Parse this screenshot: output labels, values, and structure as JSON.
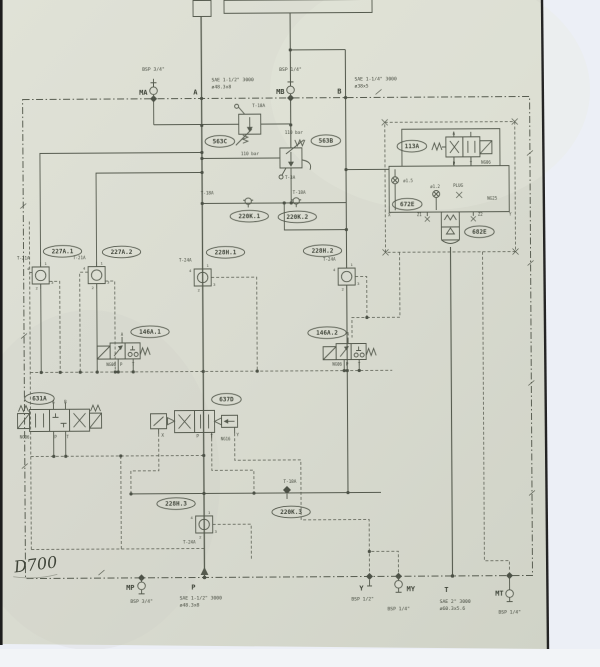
{
  "note": {
    "handwriting": "D700"
  },
  "oval_labels": [
    {
      "id": "563C",
      "x": 221,
      "y": 141
    },
    {
      "id": "563B",
      "x": 327,
      "y": 141
    },
    {
      "id": "220K.1",
      "x": 250,
      "y": 216
    },
    {
      "id": "220K.2",
      "x": 298,
      "y": 217
    },
    {
      "id": "113A",
      "x": 413,
      "y": 147
    },
    {
      "id": "672E",
      "x": 408,
      "y": 205
    },
    {
      "id": "682E",
      "x": 480,
      "y": 233
    },
    {
      "id": "227A.1",
      "x": 63,
      "y": 250
    },
    {
      "id": "227A.2",
      "x": 122,
      "y": 251
    },
    {
      "id": "228H.1",
      "x": 226,
      "y": 252
    },
    {
      "id": "228H.2",
      "x": 323,
      "y": 251
    },
    {
      "id": "146A.1",
      "x": 150,
      "y": 331
    },
    {
      "id": "146A.2",
      "x": 327,
      "y": 333
    },
    {
      "id": "631A",
      "x": 39,
      "y": 397
    },
    {
      "id": "637D",
      "x": 226,
      "y": 399
    },
    {
      "id": "228H.3",
      "x": 175,
      "y": 503
    },
    {
      "id": "220K.3",
      "x": 290,
      "y": 512
    }
  ],
  "check_valves": [
    {
      "label": "T-21A",
      "cx": 41,
      "cy": 274
    },
    {
      "label": "T-21A",
      "cx": 97,
      "cy": 274
    },
    {
      "label": "T-24A",
      "cx": 203,
      "cy": 277
    },
    {
      "label": "T-24A",
      "cx": 347,
      "cy": 277
    },
    {
      "label": "T-24A",
      "cx": 203,
      "cy": 524,
      "below": true
    }
  ],
  "test_points": [
    {
      "x": 249,
      "y": 201
    },
    {
      "x": 297,
      "y": 201
    },
    {
      "x": 286,
      "y": 490,
      "diamond": true
    }
  ],
  "ports_top": {
    "line_y": 98,
    "items": [
      {
        "id": "MA",
        "kind": "gauge",
        "x": 155,
        "thread": "BSP 3/4\"",
        "thread_y": 70,
        "dx": -6,
        "dy": -4
      },
      {
        "id": "A",
        "kind": "line",
        "x": 203,
        "spec": [
          "SAE 1-1/2\" 3000",
          "ø48.3x8"
        ],
        "spec_x": 213,
        "spec_y": 81,
        "dx": -4,
        "dy": -4
      },
      {
        "id": "MB",
        "kind": "gauge",
        "x": 292,
        "thread": "BSP 1/4\"",
        "thread_y": 71,
        "dx": -6,
        "dy": -4
      },
      {
        "id": "B",
        "kind": "line",
        "x": 347,
        "spec": [
          "SAE 1-1/4\" 3000",
          "ø38x5"
        ],
        "spec_x": 356,
        "spec_y": 81,
        "dx": -4,
        "dy": -4
      }
    ]
  },
  "ports_bottom": {
    "line_y": 577,
    "items": [
      {
        "id": "MP",
        "kind": "gauge",
        "x": 140,
        "thread": "BSP 3/4\"",
        "thread_y": 602,
        "dx": -7,
        "dy": 12
      },
      {
        "id": "P",
        "kind": "line",
        "x": 203,
        "arrow": true,
        "spec": [
          "SAE 1-1/2\" 3000",
          "ø48.3x8"
        ],
        "spec_x": 178,
        "spec_y": 599,
        "dx": -9,
        "dy": 12
      },
      {
        "id": "Y",
        "kind": "diamond",
        "x": 368,
        "thread": "BSP 1/2\"",
        "thread_x": 361,
        "thread_y": 601,
        "dx": -6,
        "dy": 14
      },
      {
        "id": "MY",
        "kind": "gauge",
        "x": 397,
        "thread": "BSP 1/4\"",
        "thread_y": 611,
        "dx": 8,
        "dy": 15,
        "anchor": "start"
      },
      {
        "id": "T",
        "kind": "line",
        "x": 451,
        "spec": [
          "SAE 2\" 3000",
          "ø60.3x5.6"
        ],
        "spec_x": 438,
        "spec_y": 604,
        "dx": -4,
        "dy": 16
      },
      {
        "id": "MT",
        "kind": "gauge",
        "x": 508,
        "thread": "BSP 1/4\"",
        "thread_y": 615,
        "dx": -6,
        "dy": 20,
        "stem": 10
      }
    ]
  },
  "texts": [
    {
      "t": "T-18A",
      "x": 260,
      "y": 107,
      "s": 4.3
    },
    {
      "t": "110 bar",
      "x": 251,
      "y": 155,
      "s": 4.3
    },
    {
      "t": "110 bar",
      "x": 295,
      "y": 134,
      "s": 4.3
    },
    {
      "t": "T-3A",
      "x": 291,
      "y": 179,
      "s": 4.3
    },
    {
      "t": "T-18A",
      "x": 208,
      "y": 194,
      "s": 4.3
    },
    {
      "t": "T-18A",
      "x": 300,
      "y": 194,
      "s": 4.3
    },
    {
      "t": "T-18A",
      "x": 289,
      "y": 483,
      "s": 4.3
    },
    {
      "t": "PLUG",
      "x": 459,
      "y": 188,
      "s": 4.2
    },
    {
      "t": "ø1.5",
      "x": 409,
      "y": 183,
      "s": 4
    },
    {
      "t": "ø1.2",
      "x": 436,
      "y": 189,
      "s": 4
    },
    {
      "t": "NG25",
      "x": 493,
      "y": 201,
      "s": 4.2
    },
    {
      "t": "Z1",
      "x": 420,
      "y": 217,
      "s": 4
    },
    {
      "t": "Z2",
      "x": 481,
      "y": 217,
      "s": 4
    },
    {
      "t": "X",
      "x": 390,
      "y": 217,
      "s": 4
    },
    {
      "t": "Y",
      "x": 511,
      "y": 217,
      "s": 4
    },
    {
      "t": "NG06",
      "x": 487,
      "y": 165,
      "s": 4
    },
    {
      "t": "A",
      "x": 455,
      "y": 136,
      "s": 4
    },
    {
      "t": "P",
      "x": 455,
      "y": 166,
      "s": 4
    },
    {
      "t": "T",
      "x": 472,
      "y": 166,
      "s": 4
    },
    {
      "t": "NG06",
      "x": 111,
      "y": 365,
      "s": 4
    },
    {
      "t": "P",
      "x": 121,
      "y": 365,
      "s": 4
    },
    {
      "t": "T",
      "x": 133,
      "y": 365,
      "s": 4
    },
    {
      "t": "A",
      "x": 122,
      "y": 335,
      "s": 4
    },
    {
      "t": "NG06",
      "x": 337,
      "y": 366,
      "s": 4
    },
    {
      "t": "P",
      "x": 347,
      "y": 366,
      "s": 4
    },
    {
      "t": "T",
      "x": 359,
      "y": 366,
      "s": 4
    },
    {
      "t": "A",
      "x": 348,
      "y": 336,
      "s": 4
    },
    {
      "t": "NG06",
      "x": 24,
      "y": 437,
      "s": 4
    },
    {
      "t": "P",
      "x": 55,
      "y": 437,
      "s": 4
    },
    {
      "t": "T",
      "x": 67,
      "y": 437,
      "s": 4
    },
    {
      "t": "A",
      "x": 53,
      "y": 402,
      "s": 4
    },
    {
      "t": "B",
      "x": 65,
      "y": 402,
      "s": 4
    },
    {
      "t": "X",
      "x": 162,
      "y": 436,
      "s": 4.3
    },
    {
      "t": "P",
      "x": 197,
      "y": 437,
      "s": 4.3
    },
    {
      "t": "T",
      "x": 211,
      "y": 437,
      "s": 4.3
    },
    {
      "t": "NG16",
      "x": 225,
      "y": 440,
      "s": 4
    },
    {
      "t": "Y",
      "x": 237,
      "y": 436,
      "s": 4.3
    }
  ]
}
